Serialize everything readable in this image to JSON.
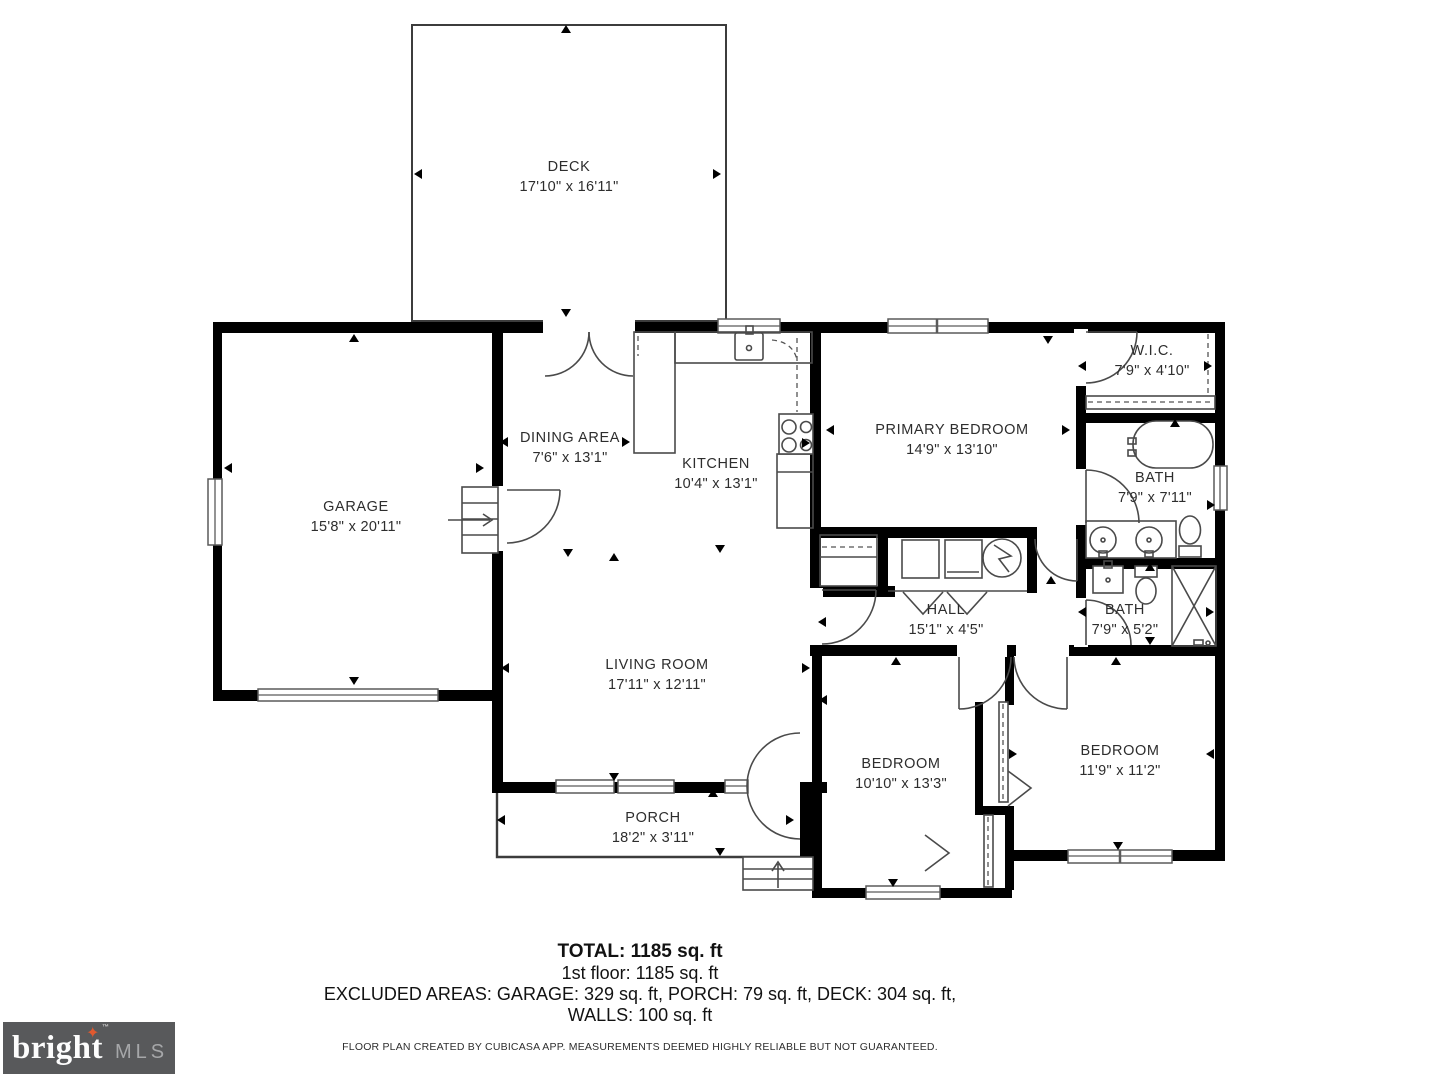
{
  "rooms": {
    "deck": {
      "label": "DECK",
      "dims": "17'10\" x 16'11\""
    },
    "garage": {
      "label": "GARAGE",
      "dims": "15'8\" x 20'11\""
    },
    "dining": {
      "label": "DINING AREA",
      "dims": "7'6\" x 13'1\""
    },
    "kitchen": {
      "label": "KITCHEN",
      "dims": "10'4\" x 13'1\""
    },
    "primary": {
      "label": "PRIMARY BEDROOM",
      "dims": "14'9\" x 13'10\""
    },
    "wic": {
      "label": "W.I.C.",
      "dims": "7'9\" x 4'10\""
    },
    "bath1": {
      "label": "BATH",
      "dims": "7'9\" x 7'11\""
    },
    "hall": {
      "label": "HALL",
      "dims": "15'1\" x 4'5\""
    },
    "bath2": {
      "label": "BATH",
      "dims": "7'9\" x 5'2\""
    },
    "living": {
      "label": "LIVING ROOM",
      "dims": "17'11\" x 12'11\""
    },
    "bedroom1": {
      "label": "BEDROOM",
      "dims": "10'10\" x 13'3\""
    },
    "bedroom2": {
      "label": "BEDROOM",
      "dims": "11'9\" x 11'2\""
    },
    "porch": {
      "label": "PORCH",
      "dims": "18'2\" x 3'11\""
    }
  },
  "footer": {
    "total": "TOTAL: 1185 sq. ft",
    "floor1": "1st floor: 1185 sq. ft",
    "excluded": "EXCLUDED AREAS: GARAGE: 329 sq. ft, PORCH: 79 sq. ft, DECK: 304 sq. ft,",
    "walls": "WALLS: 100 sq. ft",
    "disclaimer": "FLOOR PLAN CREATED BY CUBICASA APP. MEASUREMENTS DEEMED HIGHLY RELIABLE BUT NOT GUARANTEED."
  },
  "logo": {
    "brand": "bright",
    "star": "✦",
    "tm": "™",
    "suffix": "MLS",
    "bg_color": "#58595b",
    "star_color": "#e0592f"
  }
}
